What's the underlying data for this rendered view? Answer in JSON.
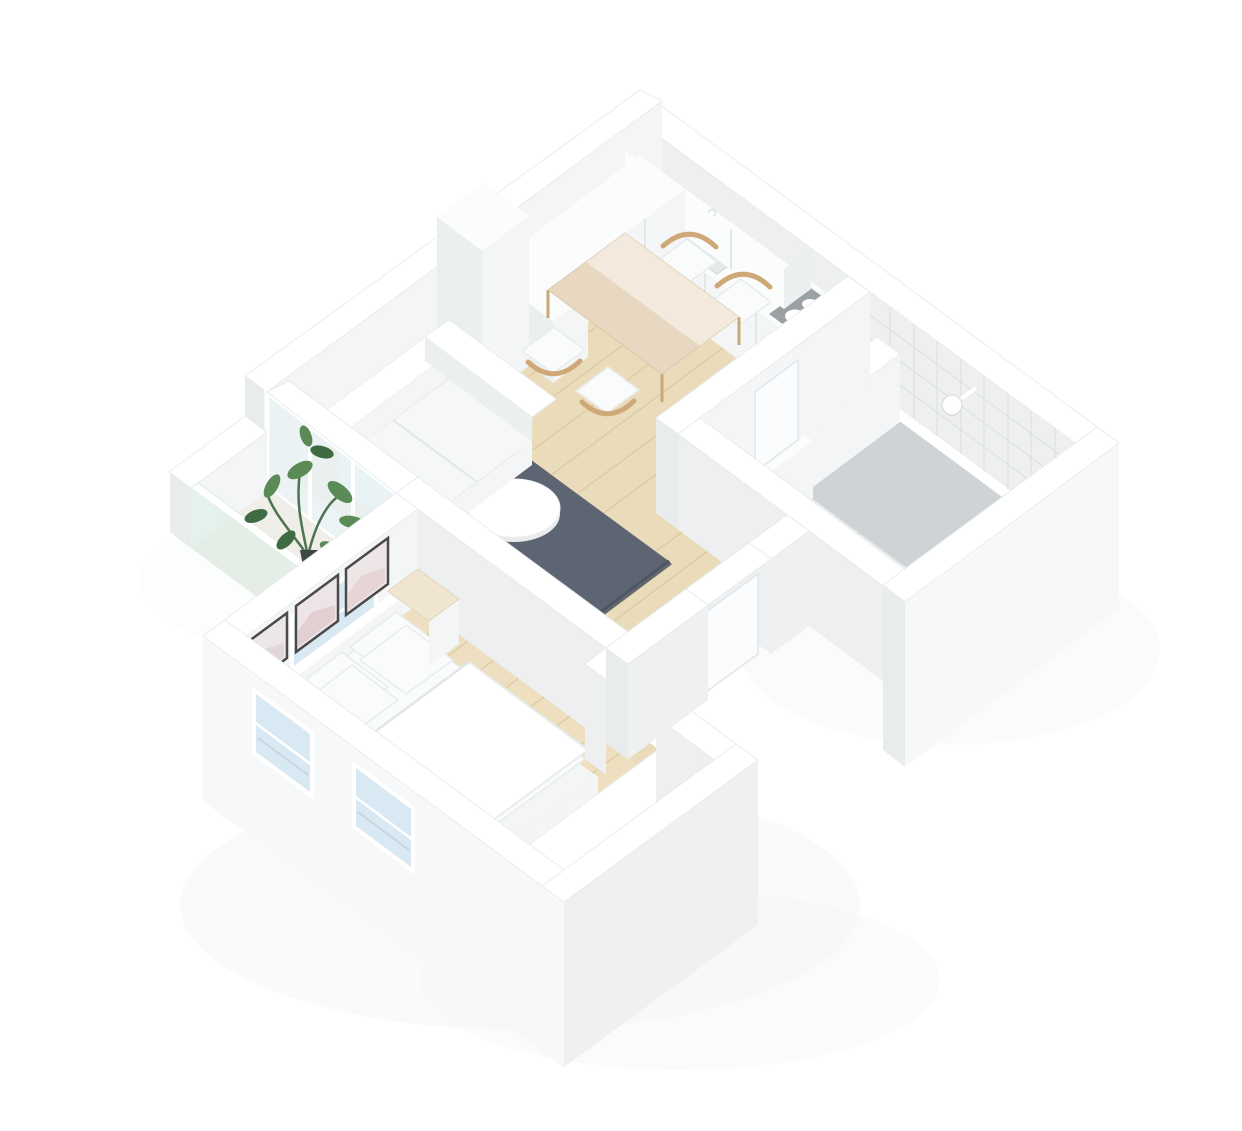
{
  "scene": {
    "description": "Isometric 3D cutaway render of a one-bedroom apartment floor plan on a white background",
    "view": "isometric-top-down",
    "background": "#ffffff",
    "rooms": [
      {
        "name": "kitchen",
        "objects": [
          "upper-cabinets",
          "counter-with-sink",
          "faucet",
          "cooktop"
        ]
      },
      {
        "name": "dining-area",
        "objects": [
          "wood-dining-table",
          "four-wood-chairs-with-white-cushions"
        ]
      },
      {
        "name": "living-room",
        "objects": [
          "white-corner-sofa",
          "dark-gray-rug",
          "round-white-coffee-table",
          "tall-white-cabinet"
        ]
      },
      {
        "name": "bathroom",
        "objects": [
          "tiled-walls",
          "tiled-floor",
          "shower-area",
          "shower-head",
          "partition-half-wall",
          "washer-unit",
          "white-door"
        ]
      },
      {
        "name": "hallway",
        "objects": [
          "wood-plank-floor",
          "entry-door"
        ]
      },
      {
        "name": "bedroom",
        "objects": [
          "double-bed",
          "white-bedding",
          "four-pillows",
          "headboard",
          "nightstand",
          "three-framed-pictures",
          "wardrobe",
          "two-windows"
        ]
      },
      {
        "name": "balcony",
        "objects": [
          "glass-balustrade",
          "potted-green-plant",
          "window-wall"
        ]
      }
    ]
  },
  "colors": {
    "background": "#ffffff",
    "wood_floor": "#eadcba",
    "wood_floor_bedroom": "#eddfbf",
    "plank_line": "#d6c29c",
    "rug": "#5d6572",
    "rug_edge": "#4c5460",
    "tile": "#eaeced",
    "tile_line": "#d9dcde",
    "shower_floor": "#ced3d5",
    "cooktop": "#9aa1a5",
    "burner": "#ffffff",
    "glass_window": "#d9e9f3",
    "glass_interior": "#e9f2f4",
    "glass_balcony": "#ddeee7",
    "chair_wood": "#cfa878",
    "table_wood": "#e9d8c1",
    "plant_leaf": "#5a8a55",
    "plant_leaf_dark": "#3f6b42",
    "plant_pot": "#3e4742",
    "picture_frame": "#4a4a4a",
    "shadow": "#aab4ba"
  }
}
